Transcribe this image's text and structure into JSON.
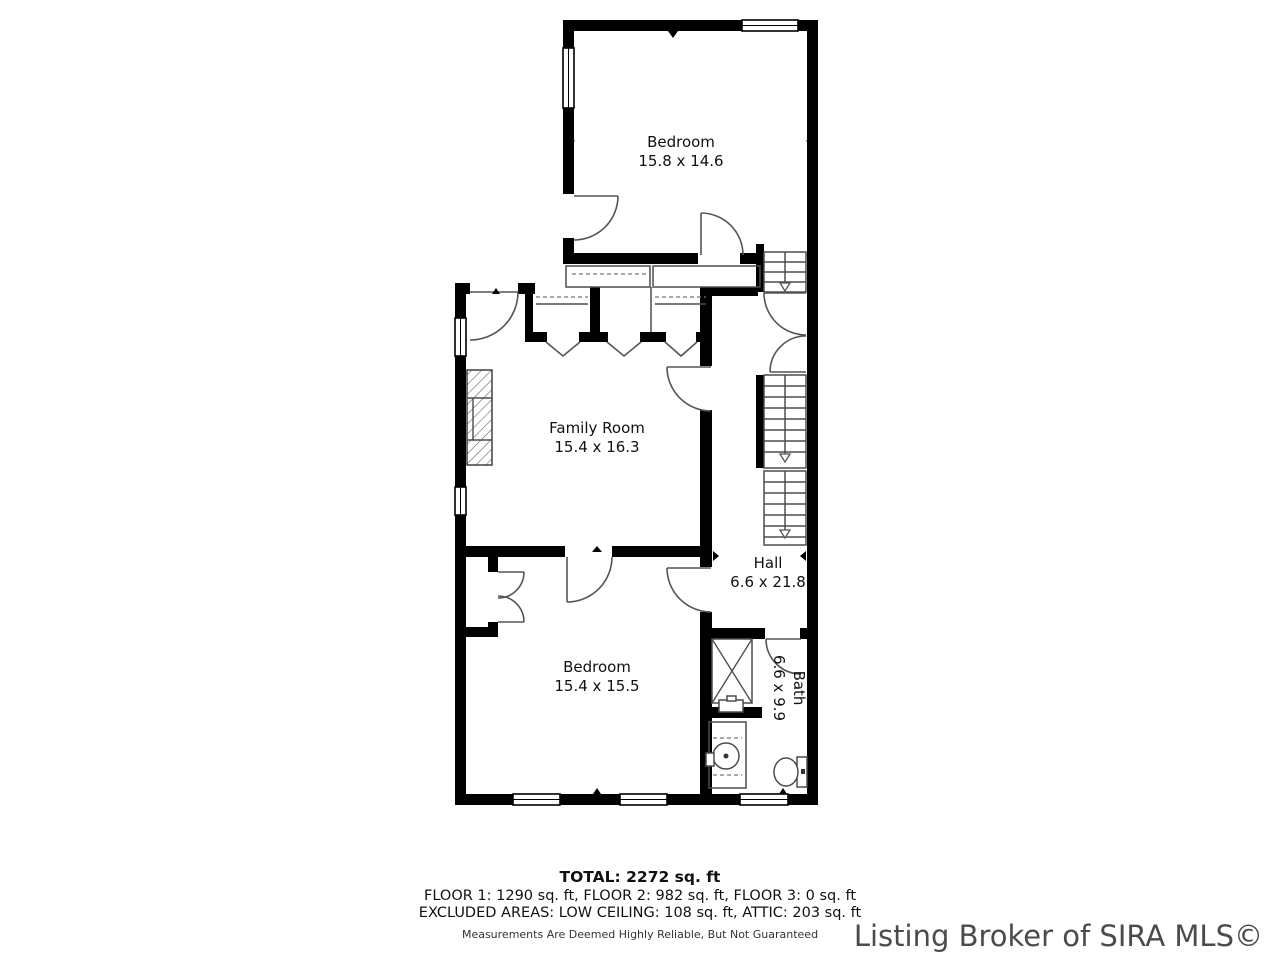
{
  "colors": {
    "wall": "#000000",
    "thin_line": "#4d4d4d",
    "label_text": "#111111",
    "watermark_text": "#4b4b4b",
    "background": "#ffffff"
  },
  "rooms": [
    {
      "name": "Bedroom",
      "dimensions": "15.8 x 14.6"
    },
    {
      "name": "Family Room",
      "dimensions": "15.4 x 16.3"
    },
    {
      "name": "Hall",
      "dimensions": "6.6 x 21.8"
    },
    {
      "name": "Bedroom",
      "dimensions": "15.4 x 15.5"
    },
    {
      "name": "Bath",
      "dimensions": "6.6 x 9.9"
    }
  ],
  "summary": {
    "total": "TOTAL: 2272 sq. ft",
    "floors": "FLOOR 1: 1290 sq. ft, FLOOR 2: 982 sq. ft, FLOOR 3: 0 sq. ft",
    "excluded": "EXCLUDED AREAS: LOW CEILING: 108 sq. ft, ATTIC: 203 sq. ft",
    "disclaimer": "Measurements Are Deemed Highly Reliable, But Not Guaranteed"
  },
  "watermark": "Listing Broker of SIRA MLS©"
}
